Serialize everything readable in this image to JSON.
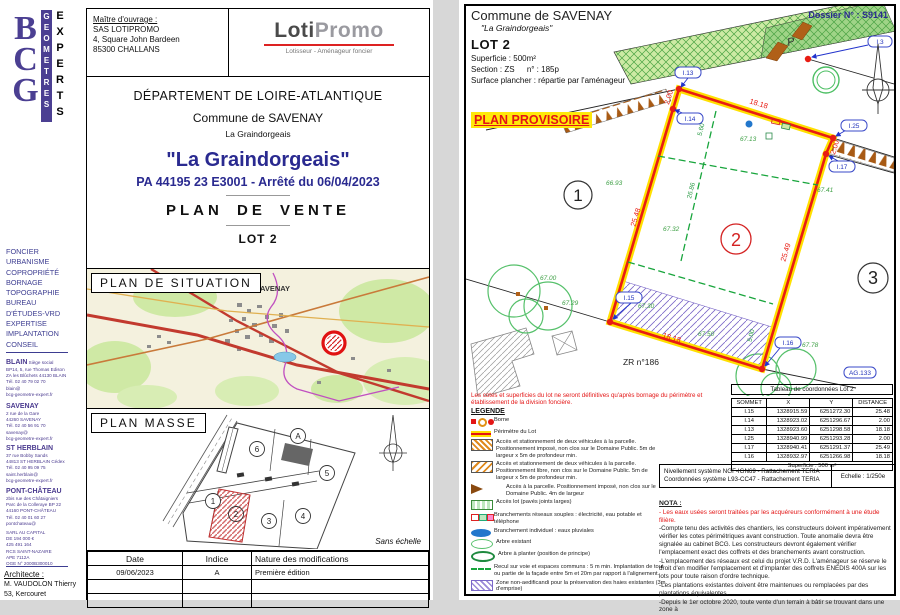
{
  "left_page": {
    "logo": {
      "letters": "BCG",
      "word1": "GEOMETRES",
      "word2": "EXPERTS"
    },
    "client": {
      "label": "Maître d'ouvrage :",
      "lines": [
        "SAS LOTIPROMO",
        "4, Square John Bardeen",
        "85300 CHALLANS"
      ]
    },
    "promoter": {
      "part1": "Loti",
      "part2": "Promo",
      "tagline": "Lotisseur - Aménageur foncier"
    },
    "titles": {
      "departement": "DÉPARTEMENT DE LOIRE-ATLANTIQUE",
      "commune": "Commune de SAVENAY",
      "lieu": "La Graindorgeais",
      "main": "\"La Graindorgeais\"",
      "pa": "PA 44195 23 E3001 - Arrêté du 06/04/2023",
      "plan": "PLAN DE VENTE",
      "lot": "LOT 2"
    },
    "sidebar": {
      "services": [
        "FONCIER",
        "URBANISME",
        "COPROPRIÉTÉ",
        "BORNAGE",
        "TOPOGRAPHIE",
        "BUREAU",
        "D'ÉTUDES-VRD",
        "EXPERTISE",
        "IMPLANTATION",
        "CONSEIL"
      ],
      "offices": [
        {
          "name": "BLAIN",
          "tag": "Siège social",
          "lines": [
            "BP14, 5, rue Thomas Edison",
            "ZA les Blûchets 44130 BLAIN",
            "Tél. 02 40 79 02 70",
            "blain@",
            "bcg-geometre-expert.fr"
          ]
        },
        {
          "name": "SAVENAY",
          "tag": "",
          "lines": [
            "2 rue de la Gare",
            "44260 SAVENAY",
            "Tél. 02 40 56 91 70",
            "savenay@",
            "bcg-geometre-expert.fr"
          ]
        },
        {
          "name": "ST HERBLAIN",
          "tag": "",
          "lines": [
            "37 rue Bobby Sands",
            "44813 ST HERBLAIN Cédex",
            "Tél. 02 40 95 09 75",
            "saint.herblain@",
            "bcg-geometre-expert.fr"
          ]
        },
        {
          "name": "PONT-CHÂTEAU",
          "tag": "",
          "lines": [
            "2bis rue des Châtaigniers",
            "Parc de la Colleraye BP 22",
            "44160 PONT-CHÂTEAU",
            "Tél. 02 40 01 60 27",
            "pontchateau@",
            "bcg-geometre-expert.fr"
          ]
        }
      ],
      "company": [
        "SARL AU CAPITAL",
        "DE 194 000 €",
        "425 491 164",
        "RCS SAINT-NAZAIRE",
        "APE 7112A",
        "OGE N° 2000B300010"
      ],
      "architect": {
        "label": "Architecte :",
        "lines": [
          "M. VAUDOLON Thierry",
          "53, Kercouret"
        ]
      }
    },
    "plan_situation": {
      "label": "PLAN DE SITUATION",
      "town": "SAVENAY"
    },
    "plan_masse": {
      "label": "PLAN MASSE",
      "note": "Sans échelle",
      "lots": [
        "1",
        "2",
        "3",
        "4",
        "5",
        "6",
        "A"
      ]
    },
    "modifications_table": {
      "headers": [
        "Date",
        "Indice",
        "Nature des modifications"
      ],
      "rows": [
        [
          "09/06/2023",
          "A",
          "Première édition"
        ],
        [
          "",
          "",
          ""
        ],
        [
          "",
          "",
          ""
        ]
      ]
    }
  },
  "right_page": {
    "header": {
      "commune": "Commune de SAVENAY",
      "sub": "\"La Graindorgeais\"",
      "dossier": "Dossier N° : S9141",
      "lot": "LOT 2",
      "superficie": "Superficie :  500m²",
      "section_label": "Section : ZS",
      "section_num": "n° : 185p",
      "surface": "Surface plancher : répartie par l'aménageur",
      "provisional": "PLAN PROVISOIRE"
    },
    "plan": {
      "vertices": [
        "I.13",
        "I.14",
        "I.25",
        "I.17",
        "I.15",
        "I.16",
        "I.3",
        "AG.133"
      ],
      "dims": {
        "top": "18.18",
        "left": "25.48",
        "right": "25.49",
        "bottom": "18.18",
        "jog_top": "2.00",
        "jog_right": "2.00"
      },
      "setbacks": {
        "front": "5.60",
        "depth": "26.86",
        "rear": "5.00"
      },
      "elevations": [
        "66.93",
        "67.00",
        "67.29",
        "67.13",
        "67.32",
        "67.41",
        "67.78",
        "67.30",
        "67.50"
      ],
      "lot_numbers": [
        "1",
        "2",
        "3"
      ],
      "parcel": "ZR n°186",
      "parking_letter": "P"
    },
    "warning": "Les cotes et superficies du lot ne seront définitives qu'après bornage du périmètre et établissement de la division foncière.",
    "legend": {
      "title": "LEGENDE",
      "items": [
        "Borne",
        "Périmètre du Lot",
        "Accès et stationnement de deux véhicules à la parcelle. Positionnement imposé, non clos sur le Domaine Public. 5m de largeur x 5m de profondeur min.",
        "Accès et stationnement de deux véhicules à la parcelle. Positionnement libre, non clos sur le Domaine Public. 5m de largeur x 5m de profondeur min.",
        "Accès à la parcelle. Positionnement imposé, non clos sur le Domaine Public. 4m de largeur",
        "Accès lot (pavés joints larges)",
        "Branchements réseaux souples : électricité, eau potable et téléphone",
        "Branchement individuel : eaux pluviales",
        "Arbre existant",
        "Arbre à planter (position de principe)",
        "Recul sur voie et espaces communs : 5 m min. Implantation de tout ou partie de la façade entre 5m et 20m par rapport à l'alignement.",
        "Zone non-aedificandi pour la préservation des haies existantes (3m d'emprise)"
      ]
    },
    "coord_table": {
      "title": "Tableau de coordonnées Lot 2",
      "headers": [
        "SOMMET",
        "X",
        "Y",
        "DISTANCE"
      ],
      "rows": [
        [
          "I.15",
          "1328915.59",
          "6251272.30",
          "25.48"
        ],
        [
          "I.14",
          "1328923.02",
          "6251296.67",
          "2.00"
        ],
        [
          "I.13",
          "1328923.60",
          "6251298.58",
          "18.18"
        ],
        [
          "I.25",
          "1328940.99",
          "6251293.28",
          "2.00"
        ],
        [
          "I.17",
          "1328940.41",
          "6251291.37",
          "25.49"
        ],
        [
          "I.16",
          "1328932.97",
          "6251266.98",
          "18.18"
        ]
      ],
      "footer": "Superficie : 500 m²"
    },
    "georef": {
      "line1": "Nivellement système NGF-IGN69 - Rattachement TERIA",
      "line2": "Coordonnées système L93-CC47 - Rattachement TERIA",
      "scale": "Echelle : 1/250e"
    },
    "nota": {
      "title": "NOTA :",
      "red_line": "- Les eaux usées seront traitées par les acquéreurs conformément à une étude filière.",
      "lines": [
        "-Compte tenu des activités des chantiers, les constructeurs doivent impérativement vérifier les cotes périmétriques avant construction. Toute anomalie devra être signalée au cabinet BCG. Les constructeurs devront également vérifier l'emplacement exact des coffrets et des branchements avant construction.",
        "-L'emplacement des réseaux est celui du projet V.R.D. L'aménageur se réserve le droit d'en modifier l'emplacement et d'implanter des coffrets ENEDIS 400A sur les lots pour toute raison d'ordre technique.",
        "-Les plantations existantes doivent être maintenues ou remplacées par des plantations équivalentes.",
        "-Depuis le 1er octobre 2020, toute vente d'un terrain à bâtir se trouvant dans une zone à"
      ]
    }
  }
}
